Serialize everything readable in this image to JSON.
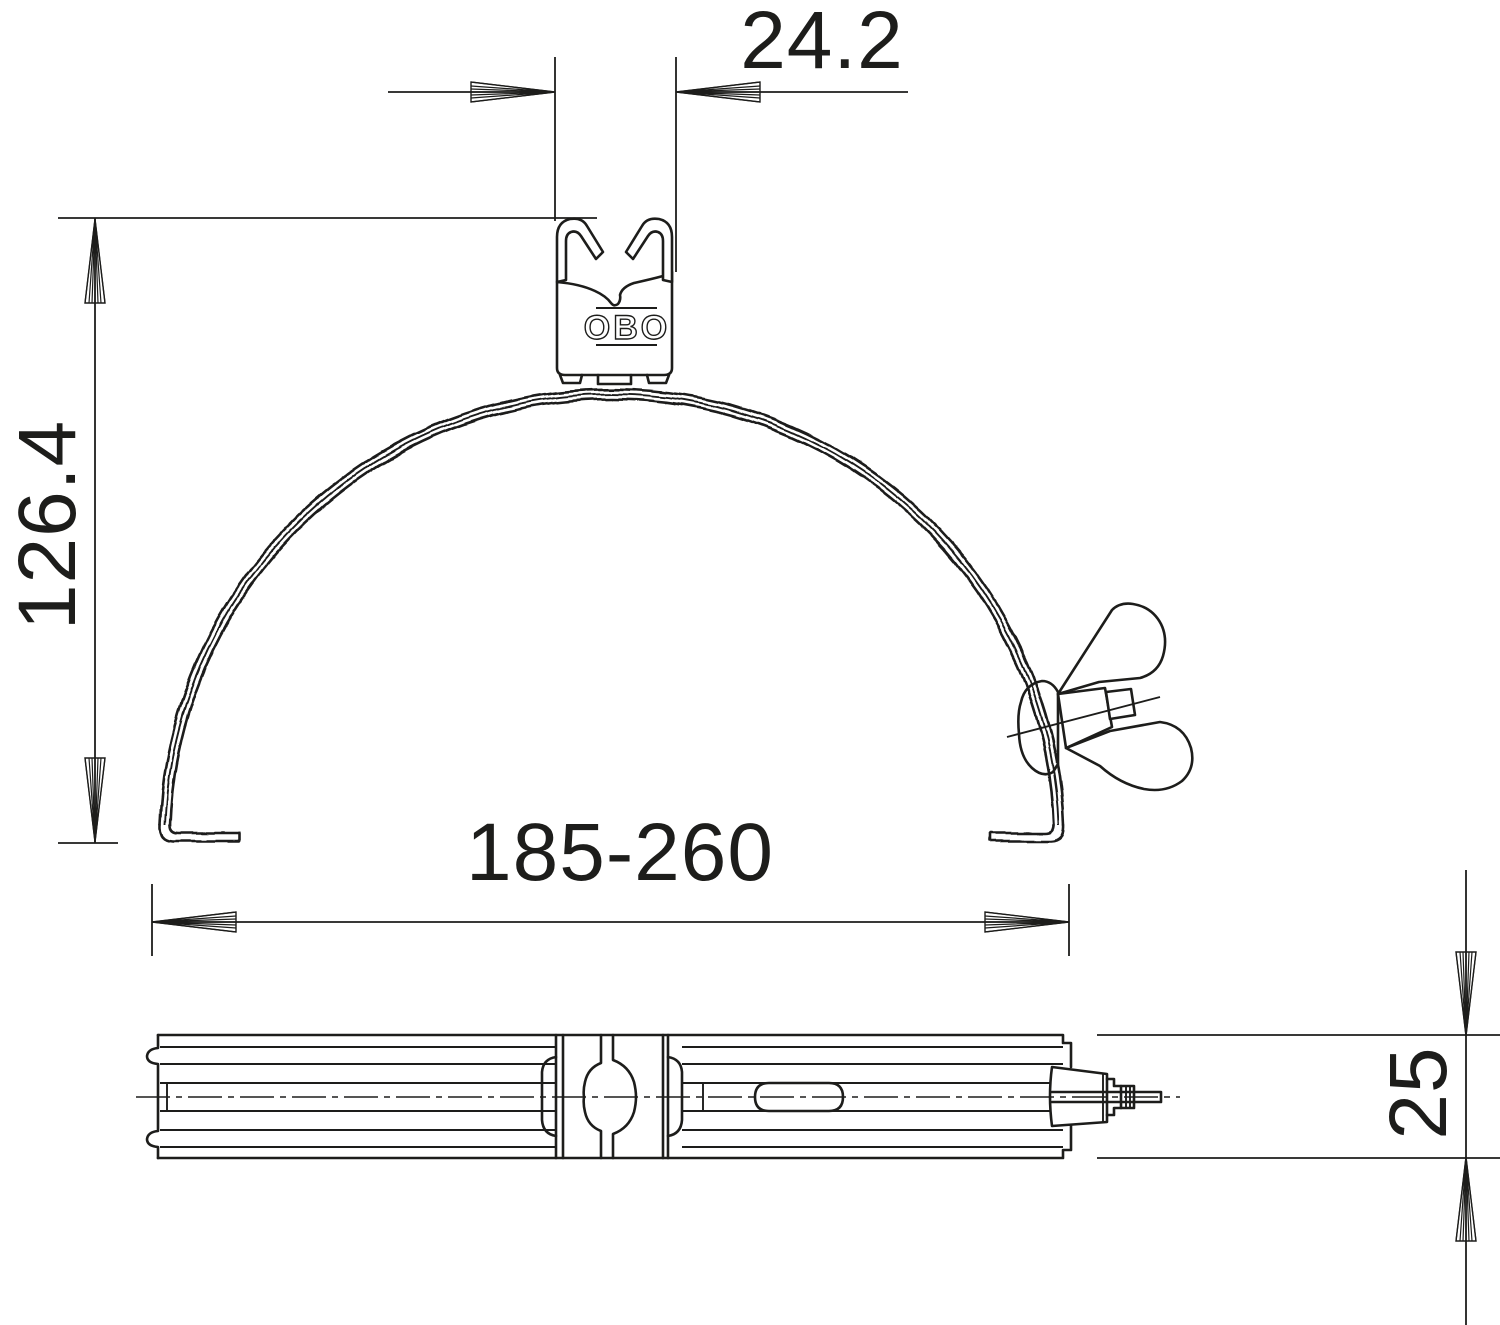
{
  "drawing": {
    "background_color": "#ffffff",
    "line_color": "#1d1d1b",
    "logo_text": "OBO",
    "dimensions": {
      "clamp_width": "24.2",
      "overall_height": "126.4",
      "clamping_range": "185-260",
      "band_width": "25"
    }
  }
}
